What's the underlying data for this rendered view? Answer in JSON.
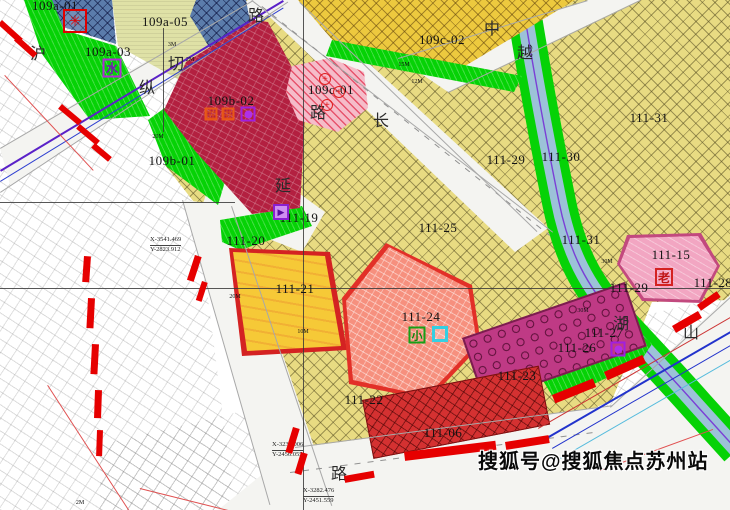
{
  "watermark": {
    "text": "搜狐号@搜狐焦点苏州站"
  },
  "parcels": [
    {
      "label": "109a-01",
      "x": 55,
      "y": 6
    },
    {
      "label": "109a-03",
      "x": 108,
      "y": 52
    },
    {
      "label": "109a-05",
      "x": 165,
      "y": 22
    },
    {
      "label": "109b-01",
      "x": 172,
      "y": 161
    },
    {
      "label": "109b-02",
      "x": 231,
      "y": 101
    },
    {
      "label": "109c-01",
      "x": 331,
      "y": 90
    },
    {
      "label": "109c-02",
      "x": 442,
      "y": 40
    },
    {
      "label": "111-31",
      "x": 649,
      "y": 118
    },
    {
      "label": "111-29",
      "x": 506,
      "y": 160
    },
    {
      "label": "111-30",
      "x": 561,
      "y": 157
    },
    {
      "label": "111-25",
      "x": 438,
      "y": 228
    },
    {
      "label": "111-31",
      "x": 581,
      "y": 240
    },
    {
      "label": "111-15",
      "x": 671,
      "y": 255
    },
    {
      "label": "111-28",
      "x": 713,
      "y": 283
    },
    {
      "label": "111-29",
      "x": 629,
      "y": 288
    },
    {
      "label": "111-19",
      "x": 299,
      "y": 218
    },
    {
      "label": "111-20",
      "x": 246,
      "y": 241
    },
    {
      "label": "111-21",
      "x": 295,
      "y": 289
    },
    {
      "label": "111-24",
      "x": 421,
      "y": 317
    },
    {
      "label": "111-22",
      "x": 364,
      "y": 400
    },
    {
      "label": "111-23",
      "x": 517,
      "y": 376
    },
    {
      "label": "111-06",
      "x": 443,
      "y": 433
    },
    {
      "label": "111-27",
      "x": 604,
      "y": 333
    },
    {
      "label": "111-26",
      "x": 577,
      "y": 348
    }
  ],
  "road_names": [
    {
      "char": "沪",
      "x": 38,
      "y": 52
    },
    {
      "char": "路",
      "x": 256,
      "y": 14
    },
    {
      "char": "切",
      "x": 176,
      "y": 62
    },
    {
      "char": "纵",
      "x": 147,
      "y": 86
    },
    {
      "char": "长",
      "x": 381,
      "y": 119
    },
    {
      "char": "延",
      "x": 283,
      "y": 184
    },
    {
      "char": "路",
      "x": 318,
      "y": 111
    },
    {
      "char": "中",
      "x": 492,
      "y": 27
    },
    {
      "char": "越",
      "x": 525,
      "y": 51
    },
    {
      "char": "湖",
      "x": 621,
      "y": 322
    },
    {
      "char": "山",
      "x": 691,
      "y": 331
    },
    {
      "char": "路",
      "x": 339,
      "y": 472
    }
  ],
  "icons": [
    {
      "name": "utility-wheel-icon",
      "type": "wheel",
      "glyph": "✳",
      "x": 75,
      "y": 21
    },
    {
      "name": "water-facility-icon",
      "type": "water",
      "glyph": "水",
      "x": 112,
      "y": 68
    },
    {
      "name": "orange-facility-icon-1",
      "type": "orange",
      "glyph": "",
      "x": 211,
      "y": 114
    },
    {
      "name": "orange-facility-icon-2",
      "type": "orange",
      "glyph": "",
      "x": 228,
      "y": 114
    },
    {
      "name": "purple-dot-facility-icon",
      "type": "pdot",
      "glyph": "",
      "x": 248,
      "y": 114
    },
    {
      "name": "purple-facility-icon",
      "type": "p19",
      "glyph": "▶",
      "x": 281,
      "y": 212
    },
    {
      "name": "primary-school-icon",
      "type": "school",
      "glyph": "小",
      "x": 417,
      "y": 335
    },
    {
      "name": "kindergarten-box-icon",
      "type": "cyan",
      "glyph": "",
      "x": 440,
      "y": 334
    },
    {
      "name": "elderly-care-icon",
      "type": "elder",
      "glyph": "老",
      "x": 664,
      "y": 277
    },
    {
      "name": "purple-dot-facility-icon-2",
      "type": "pdot",
      "glyph": "",
      "x": 618,
      "y": 349
    },
    {
      "name": "hospital-cross-icon-1",
      "type": "hosp",
      "glyph": "+",
      "x": 325,
      "y": 79
    },
    {
      "name": "hospital-cross-icon-2",
      "type": "hosp",
      "glyph": "+",
      "x": 339,
      "y": 92
    },
    {
      "name": "hospital-cross-icon-3",
      "type": "hosp",
      "glyph": "+",
      "x": 327,
      "y": 105
    }
  ],
  "dimension_markers": [
    {
      "text": "3M",
      "x": 172,
      "y": 45
    },
    {
      "text": "2M",
      "x": 190,
      "y": 60
    },
    {
      "text": "15M",
      "x": 404,
      "y": 65
    },
    {
      "text": "12M",
      "x": 417,
      "y": 82
    },
    {
      "text": "20M",
      "x": 158,
      "y": 137
    },
    {
      "text": "20M",
      "x": 235,
      "y": 297
    },
    {
      "text": "30M",
      "x": 583,
      "y": 311
    },
    {
      "text": "30M",
      "x": 607,
      "y": 262
    },
    {
      "text": "10M",
      "x": 303,
      "y": 332
    },
    {
      "text": "2M",
      "x": 80,
      "y": 503
    }
  ],
  "survey_points": [
    {
      "x_text": "X-3541.469",
      "y_text": "Y-2823.912",
      "px": 150,
      "py": 236
    },
    {
      "x_text": "X-3234.006",
      "y_text": "Y-2456.055",
      "px": 272,
      "py": 441
    },
    {
      "x_text": "X-3282.476",
      "y_text": "Y-2451.559",
      "px": 303,
      "py": 487
    }
  ],
  "colors": {
    "residential_yellow": "#e8db82",
    "commercial_yellow": "#edc93e",
    "green_space": "#06d206",
    "crimson_block": "#b32040",
    "blue_block": "#5b7cab",
    "river_blue": "#9cc2d8",
    "salmon_block": "#f6907e",
    "magenta_block": "#bf3a85",
    "red_block": "#d43131",
    "pink_block": "#f2a6c2",
    "road_white": "#f4f4f1",
    "dash_red": "#e60000",
    "boundary_purple": "#5a21c8"
  }
}
